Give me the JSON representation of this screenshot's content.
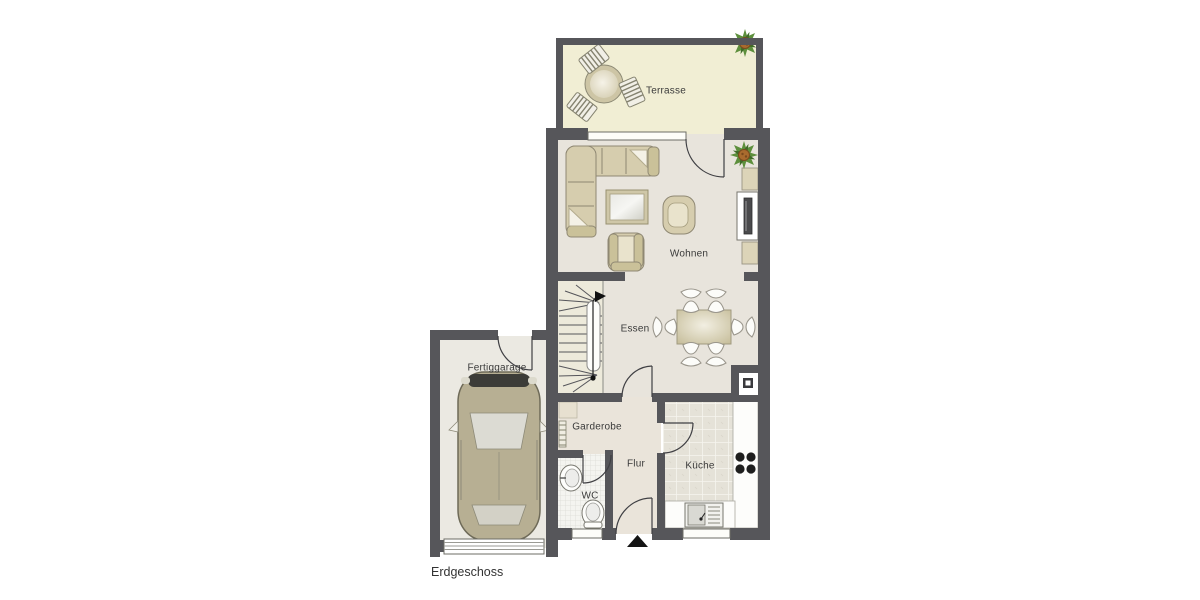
{
  "title": {
    "floor_label": "Erdgeschoss"
  },
  "rooms": {
    "terrasse": "Terrasse",
    "wohnen": "Wohnen",
    "essen": "Essen",
    "fertiggarage": "Fertiggarage",
    "garderobe": "Garderobe",
    "flur": "Flur",
    "wc": "WC",
    "kueche": "Küche"
  },
  "elements": [
    "corner-sofa",
    "coffee-table",
    "armchair",
    "armchair",
    "tv-lowboard",
    "plant",
    "plant",
    "dining-table",
    "dining-chair-x6",
    "winder-staircase",
    "terrace-round-table",
    "terrace-chair-x3",
    "car",
    "garage-sectional-door",
    "coat-rack",
    "wardrobe",
    "wc-sink",
    "toilet",
    "kitchen-sink",
    "stove-4-burners",
    "chimney-flue",
    "entrance-arrow",
    "terrace-window",
    "wc-window",
    "kitchen-window"
  ],
  "colors": {
    "wall": "#56565a",
    "terrace_floor": "#f1eed4",
    "living_floor": "#e8e4dc",
    "hall_floor": "#eae4da",
    "stairs_floor": "#edeadb",
    "garage_floor": "#ebe9e2",
    "kitchen_tiles": "#e5e2d8",
    "wc_tiles": "#f4f4f0",
    "furniture": "#d6cdae",
    "car_body": "#b7af93",
    "plant_green": "#5d8f3c",
    "plant_center": "#a96b2e",
    "label_text": "#3a3a3a"
  }
}
